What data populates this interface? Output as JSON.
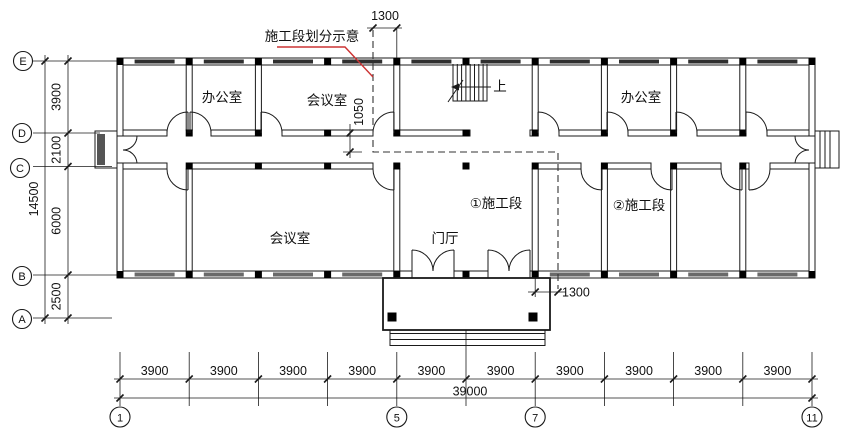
{
  "drawing": {
    "note_divider": "施工段划分示意",
    "stairs_up": "上",
    "rooms": {
      "office_west": "办公室",
      "meeting_north": "会议室",
      "office_east": "办公室",
      "meeting_south": "会议室",
      "lobby": "门厅",
      "section_1": "①施工段",
      "section_2": "②施工段"
    },
    "dims": {
      "top_offset": "1300",
      "corridor_offset": "1050",
      "bottom_offset": "1300",
      "left_segments": [
        "3900",
        "2100",
        "6000",
        "2500"
      ],
      "left_total": "14500",
      "bottom_segments": [
        "3900",
        "3900",
        "3900",
        "3900",
        "3900",
        "3900",
        "3900",
        "3900",
        "3900",
        "3900"
      ],
      "bottom_total": "39000"
    },
    "grid": {
      "rows": [
        "E",
        "D",
        "C",
        "B",
        "A"
      ],
      "cols": [
        "1",
        "5",
        "7",
        "11"
      ]
    },
    "colors": {
      "line": "#1a1a1a",
      "leader_red": "#cc3333",
      "window_dark": "#2f2f2f",
      "window_gray": "#6a6a6a",
      "column_fill": "#000000"
    }
  }
}
